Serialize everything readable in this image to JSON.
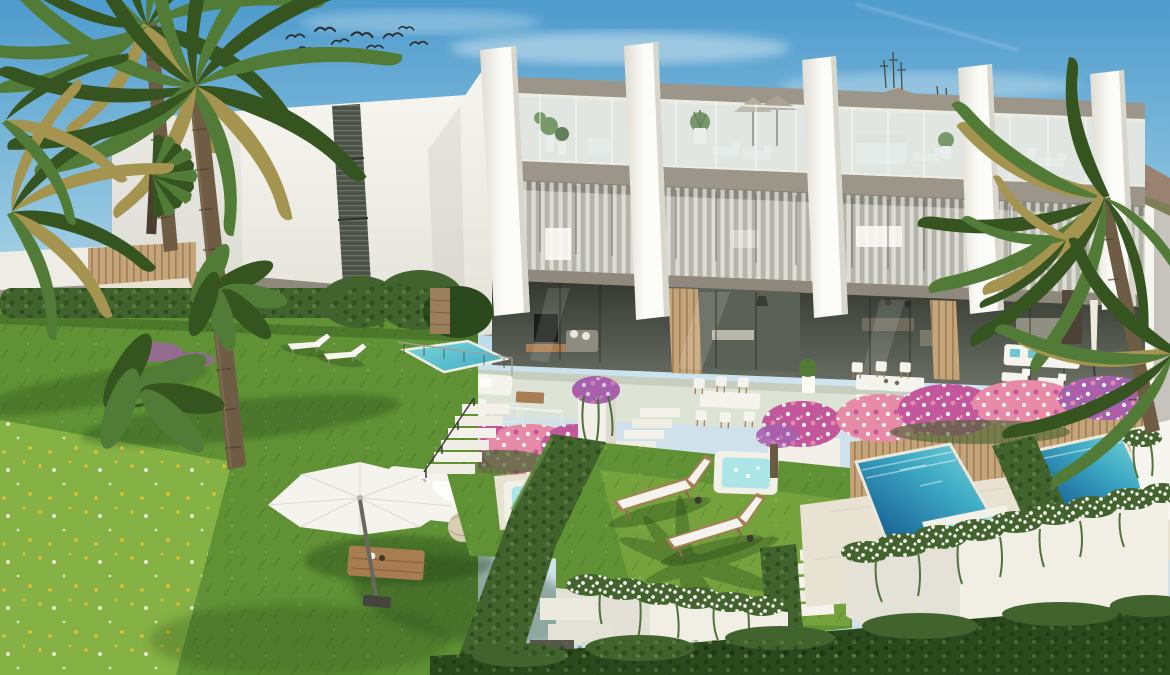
{
  "palette": {
    "sky_top": "#4e9bcd",
    "sky_mid": "#8cc2de",
    "sky_low": "#d4e8f0",
    "cloud": "#edf4f6",
    "mountain": "#9a8273",
    "mountain_dark": "#7b6156",
    "mountain_light": "#b3a08b",
    "hill_green": "#7f7f55",
    "wall_white": "#f6f5f0",
    "wall_shade": "#e3e1d8",
    "fin_white": "#fcfcf9",
    "fin_shade": "#dfdcd3",
    "taupe": "#9c958a",
    "taupe_dark": "#7d766b",
    "glass_tint": "#c6dade",
    "interior_white": "#edece5",
    "interior_mid": "#6d7268",
    "interior_dark": "#4d524a",
    "louver": "#4c5248",
    "wood_slat": "#c6a47a",
    "wood_dark": "#8c6d4c",
    "furn_wood": "#a87d51",
    "deck": "#e8e2d3",
    "terrace_floor": "#dde3d5",
    "grass_bright": "#86b144",
    "grass_mid": "#609135",
    "grass_dark": "#3f6b26",
    "hedge": "#42632d",
    "hedge_dark": "#2c481d",
    "palm_green": "#527b37",
    "palm_dark": "#355420",
    "palm_dry": "#a4944f",
    "trunk": "#6e5c45",
    "trunk_dark": "#4d3f2f",
    "pool_shallow": "#7dd8db",
    "pool_mid": "#3ea9c4",
    "pool_deep": "#1f6f9e",
    "pool_deepest": "#144f7a",
    "jacuzzi": "#abe5e5",
    "flower_pink": "#e78aa7",
    "flower_magenta": "#c2579c",
    "flower_purple": "#a560ae",
    "flower_white": "#f4f3ec",
    "flower_yellow": "#e2c32f",
    "furn_white": "#f4f3ee",
    "teal_pillow": "#6ec5cf",
    "bird": "#2c2e2d",
    "shadow_green": "#1d3a13",
    "metal": "#3c3c38"
  },
  "scene": {
    "description": "Aerial 3D architectural render of a row of modern three-storey townhouses on a hillside with roof terraces, private terraced gardens, turquoise pools, hot tubs and lush mediterranean landscaping",
    "sky": {
      "label": "blue sky with light haze, faint contrail and a flock of birds",
      "birds": 9
    },
    "mountain": {
      "label": "mountain ridge with antenna masts on the summit"
    },
    "background_building": {
      "label": "white apartment block with dark vertical louvre strip"
    },
    "communal_area": {
      "label": "distant communal deck with small pool and loungers behind timber screen"
    },
    "townhouses": {
      "label": "row of townhouses with slanted white fin party-walls",
      "visible_units": 4,
      "fins": 5,
      "levels": [
        {
          "name": "roof terrace",
          "features": [
            "glass balustrade",
            "grey parasols",
            "white loungers",
            "white daybed",
            "potted plants"
          ]
        },
        {
          "name": "bedroom floor",
          "features": [
            "floor-to-ceiling glazing",
            "white curtains",
            "beds and dresser visible"
          ]
        },
        {
          "name": "garden level",
          "features": [
            "open-plan living rooms",
            "TV wall",
            "timber slat cladding",
            "terraces with lounge and dining furniture"
          ]
        }
      ]
    },
    "terraces": {
      "label": "unit terraces",
      "furniture": [
        "white outdoor sofa set with glass tables",
        "dining table with six chairs",
        "white sofa with teal pillows",
        "closed parasol"
      ]
    },
    "gardens": {
      "label": "stepped private gardens",
      "features": [
        "bougainvillea planters in pink, magenta and purple",
        "timber slat planter walls",
        "white staircases with handrails",
        "lawns",
        "wildflower meadow",
        "clipped hedges",
        "white retaining walls with trailing white blossom garlands"
      ]
    },
    "water": {
      "label": "turquoise pools and white hot tubs",
      "pools_visible": 4,
      "hot_tubs": 3
    },
    "lawn_furniture": {
      "label": "lawn furniture",
      "items": [
        "white cantilever parasol",
        "white daybed with grey cushion",
        "rattan pouf",
        "timber coffee table",
        "2 white loungers",
        "2 timber loungers with white cushions"
      ]
    },
    "vegetation": {
      "label": "tall palms, fan palm, banana plants and overhanging fronds"
    }
  }
}
